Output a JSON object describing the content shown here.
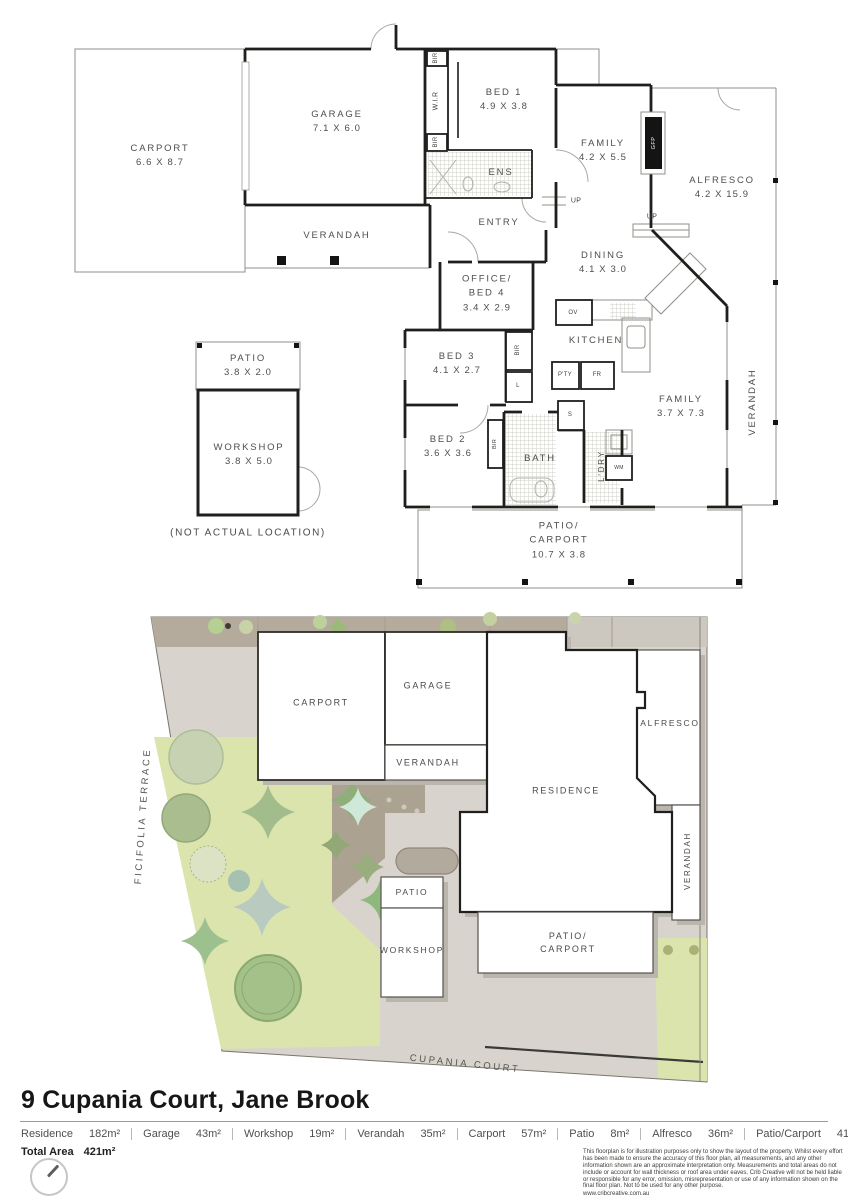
{
  "floorplan": {
    "carport": {
      "name": "CARPORT",
      "dims": "6.6 X 8.7"
    },
    "garage": {
      "name": "GARAGE",
      "dims": "7.1 X 6.0"
    },
    "verandah_top": {
      "name": "VERANDAH"
    },
    "bed1": {
      "name": "BED 1",
      "dims": "4.9 X 3.8"
    },
    "family_top": {
      "name": "FAMILY",
      "dims": "4.2 X 5.5"
    },
    "alfresco": {
      "name": "ALFRESCO",
      "dims": "4.2 X 15.9"
    },
    "verandah_right": {
      "name": "VERANDAH"
    },
    "ens": {
      "name": "ENS"
    },
    "entry": {
      "name": "ENTRY"
    },
    "dining": {
      "name": "DINING",
      "dims": "4.1 X 3.0"
    },
    "office": {
      "line1": "OFFICE/",
      "line2": "BED 4",
      "dims": "3.4 X 2.9"
    },
    "kitchen": {
      "name": "KITCHEN"
    },
    "bed3": {
      "name": "BED 3",
      "dims": "4.1 X 2.7"
    },
    "family_rear": {
      "name": "FAMILY",
      "dims": "3.7 X 7.3"
    },
    "bed2": {
      "name": "BED 2",
      "dims": "3.6 X 3.6"
    },
    "bath": {
      "name": "BATH"
    },
    "ldry": {
      "name": "L'DRY"
    },
    "patio_carport": {
      "line1": "PATIO/",
      "line2": "CARPORT",
      "dims": "10.7 X 3.8"
    },
    "patio": {
      "name": "PATIO",
      "dims": "3.8 X 2.0"
    },
    "workshop": {
      "name": "WORKSHOP",
      "dims": "3.8 X 5.0"
    },
    "note": "(NOT ACTUAL LOCATION)",
    "fixtures": {
      "wir": "W.I.R",
      "bir": "BIR",
      "l": "L",
      "s": "S",
      "up": "UP",
      "ov": "OV",
      "pty": "P'TY",
      "fr": "FR",
      "wm": "WM",
      "gfp": "GFP"
    }
  },
  "siteplan": {
    "carport": "CARPORT",
    "garage": "GARAGE",
    "verandah": "VERANDAH",
    "alfresco": "ALFRESCO",
    "residence": "RESIDENCE",
    "verandah_side": "VERANDAH",
    "patio": "PATIO",
    "workshop": "WORKSHOP",
    "patio_carport_1": "PATIO/",
    "patio_carport_2": "CARPORT",
    "street_left": "FICIFOLIA TERRACE",
    "street_bottom": "CUPANIA COURT"
  },
  "footer": {
    "title": "9 Cupania Court, Jane Brook",
    "areas": [
      {
        "name": "Residence",
        "value": "182m²"
      },
      {
        "name": "Garage",
        "value": "43m²"
      },
      {
        "name": "Workshop",
        "value": "19m²"
      },
      {
        "name": "Verandah",
        "value": "35m²"
      },
      {
        "name": "Carport",
        "value": "57m²"
      },
      {
        "name": "Patio",
        "value": "8m²"
      },
      {
        "name": "Alfresco",
        "value": "36m²"
      },
      {
        "name": "Patio/Carport",
        "value": "41m²"
      }
    ],
    "total_label": "Total Area",
    "total_value": "421m²",
    "disclaimer": "This floorplan is for illustration purposes only to show the layout of the property. Whilst every effort has been made to ensure the accuracy of this floor plan, all measurements, and any other information shown are an approximate interpretation only. Measurements and total areas do not include or account for wall thickness or roof area under eaves. Crib Creative will not be held liable or responsible for any error, omission, misrepresentation or use of any information shown on the final floor plan. Not to be used for any other purpose.",
    "website": "www.cribcreative.com.au"
  },
  "colors": {
    "wall": "#1f1f1d",
    "thin_line": "#8f8f8a",
    "label": "#4e4e4b",
    "lawn": "#dce4ad",
    "paving": "#d8d4cd",
    "driveway": "#b4ab9c",
    "tree": "#a9c08d"
  }
}
